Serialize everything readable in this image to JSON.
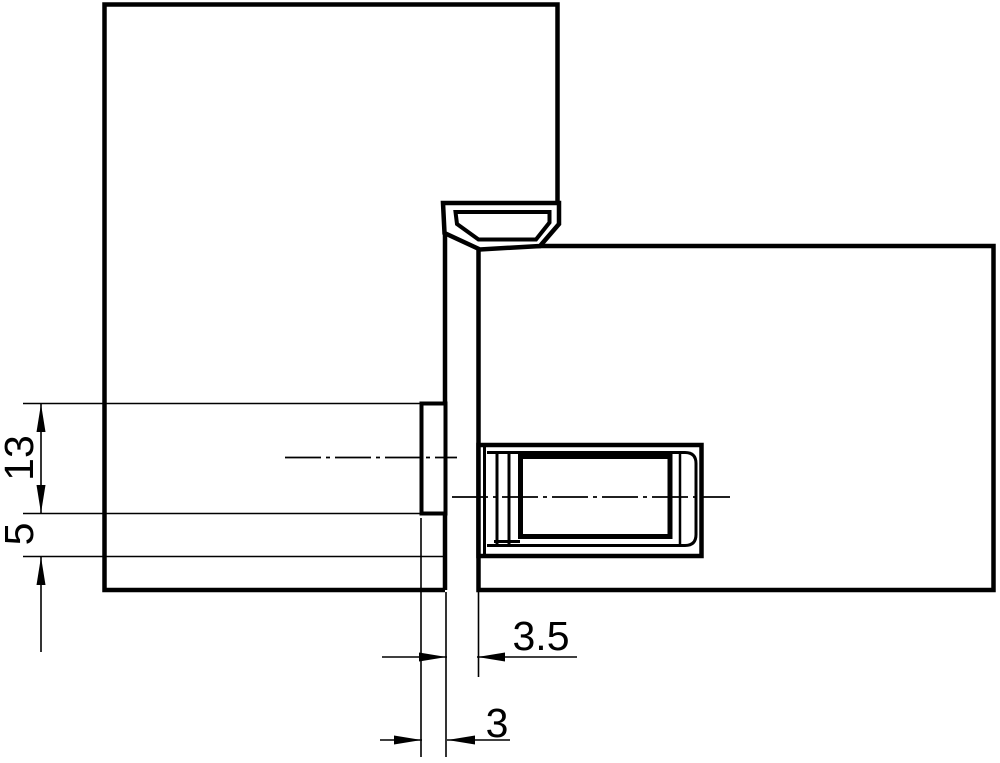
{
  "drawing": {
    "type": "technical-section-drawing",
    "subject": "concealed hinge cross-section between frame panel and door panel",
    "colors": {
      "line": "#000000",
      "background": "#ffffff"
    },
    "dimensions": {
      "d13": {
        "label": "13",
        "orientation": "vertical"
      },
      "d5": {
        "label": "5",
        "orientation": "vertical"
      },
      "d3_5": {
        "label": "3.5",
        "orientation": "horizontal"
      },
      "d3": {
        "label": "3",
        "orientation": "horizontal"
      }
    }
  }
}
